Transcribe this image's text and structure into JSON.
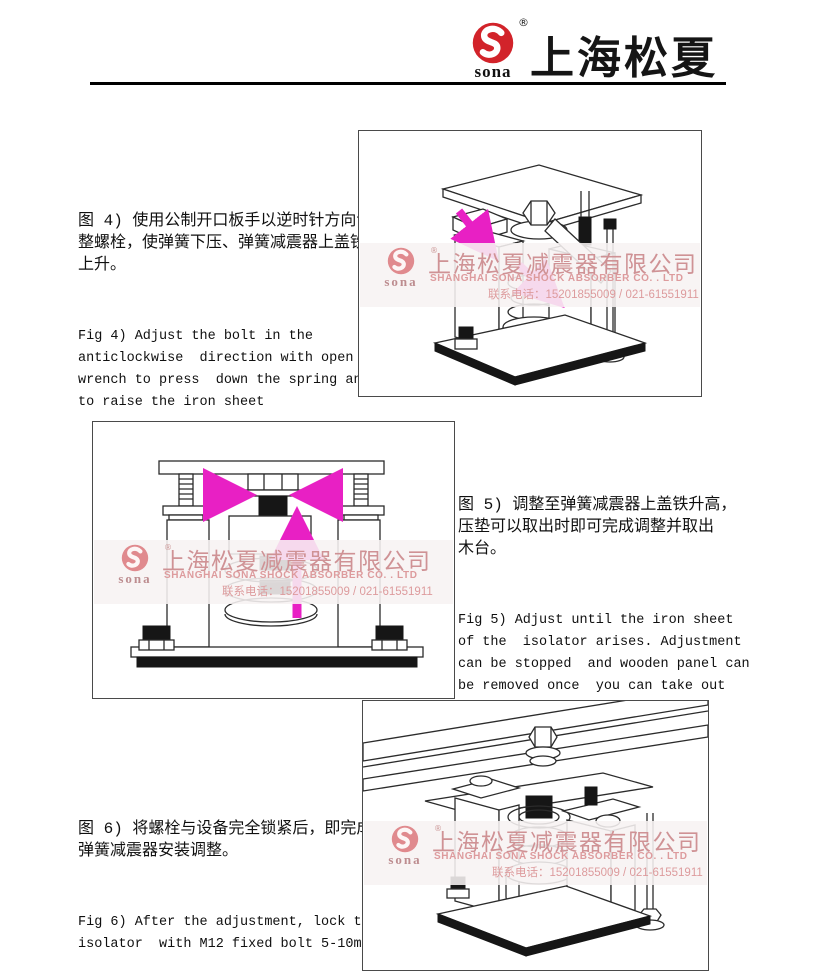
{
  "header": {
    "brand_cn": "上海松夏",
    "logo_text": "sona",
    "registered_mark": "®"
  },
  "watermark": {
    "logo_text": "sona",
    "registered_mark": "®",
    "company_cn": "上海松夏减震器有限公司",
    "company_en": "SHANGHAI SONA SHOCK ABSORBER CO. . LTD",
    "phone": "联系电话：15201855009 / 021-61551911"
  },
  "colors": {
    "brand_red": "#d2232a",
    "arrow_magenta": "#e820c4",
    "watermark_pink": "#cf9295"
  },
  "blocks": {
    "fig4": {
      "cn": "图 4) 使用公制开口板手以逆时针方向调\n整螺栓，使弹簧下压、弹簧减震器上盖铁\n上升。",
      "en": "Fig 4) Adjust the bolt in the\nanticlockwise  direction with open\nwrench to press  down the spring and\nto raise the iron sheet"
    },
    "fig5": {
      "cn": "图 5) 调整至弹簧减震器上盖铁升高，\n压垫可以取出时即可完成调整并取出\n木台。",
      "en": "Fig 5) Adjust until the iron sheet\nof the  isolator arises. Adjustment\ncan be stopped  and wooden panel can\nbe removed once  you can take out\nthe pressure pad."
    },
    "fig6": {
      "cn": "图 6) 将螺栓与设备完全锁紧后，即完成\n弹簧减震器安装调整。",
      "en": "Fig 6) After the adjustment, lock the\nisolator  with M12 fixed bolt 5-10mm"
    }
  }
}
